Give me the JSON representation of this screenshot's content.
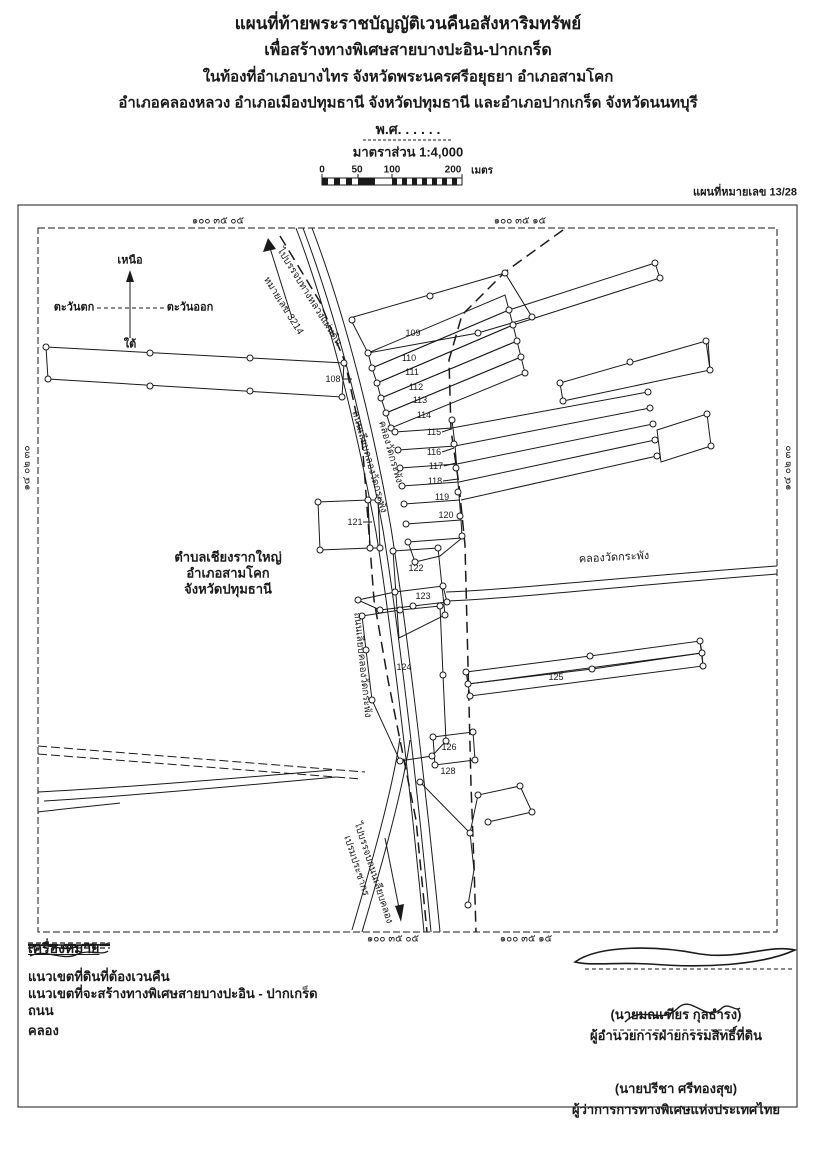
{
  "header": {
    "title_line1": "แผนที่ท้ายพระราชบัญญัติเวนคืนอสังหาริมทรัพย์",
    "title_line2": "เพื่อสร้างทางพิเศษสายบางปะอิน-ปากเกร็ด",
    "title_line3": "ในท้องที่อำเภอบางไทร จังหวัดพระนครศรีอยุธยา อำเภอสามโคก",
    "title_line4": "อำเภอคลองหลวง อำเภอเมืองปทุมธานี จังหวัดปทุมธานี และอำเภอปากเกร็ด จังหวัดนนทบุรี",
    "era_line": "พ.ศ. . . . . .",
    "scale_label": "มาตราส่วน 1:4,000",
    "scale_ticks": {
      "t0": "0",
      "t50": "50",
      "t100": "100",
      "t200": "200",
      "unit": "เมตร"
    },
    "sheet_number": "แผนที่หมายเลข 13/28"
  },
  "compass": {
    "north": "เหนือ",
    "south": "ใต้",
    "east": "ตะวันออก",
    "west": "ตะวันตก"
  },
  "coordinates": {
    "top_left": "๑๐๐ ๓๕ ๐๕",
    "top_right": "๑๐๐ ๓๕ ๑๕",
    "bottom_left": "๑๐๐ ๓๕ ๐๕",
    "bottom_right": "๑๐๐ ๓๕ ๑๕",
    "left_edge": "๑๔ ๐๒ ๓๐",
    "right_edge": "๑๔ ๐๒ ๓๐"
  },
  "map": {
    "area_label": {
      "line1": "ตำบลเชียงรากใหญ่",
      "line2": "อำเภอสามโคก",
      "line3": "จังหวัดปทุมธานี"
    },
    "road_to_north": {
      "line1": "ไปบรรจบทางหลวงแผ่นดิน",
      "line2": "หมายเลข 3214"
    },
    "road_to_south": {
      "line1": "ไปบรรจบถนนเลียบคลอง",
      "line2": "เปรมประชากร"
    },
    "canal_along_road": "คลองวัดกระพัง",
    "road_along_canal": "ถนนเลียบคลองวัดกระพัง",
    "canal_horizontal": "คลองวัดกระพัง",
    "parcels": [
      "108",
      "109",
      "110",
      "111",
      "112",
      "113",
      "114",
      "115",
      "116",
      "117",
      "118",
      "119",
      "120",
      "121",
      "122",
      "123",
      "124",
      "125",
      "126",
      "128"
    ]
  },
  "legend": {
    "heading": "เครื่องหมาย",
    "items": [
      {
        "symbol": "solid-line",
        "label": "แนวเขตที่ดินที่ต้องเวนคืน"
      },
      {
        "symbol": "long-dash-line",
        "label": "แนวเขตที่จะสร้างทางพิเศษสายบางปะอิน - ปากเกร็ด"
      },
      {
        "symbol": "double-dash-line",
        "label": "ถนน"
      },
      {
        "symbol": "wavy-line",
        "label": "คลอง"
      }
    ]
  },
  "signatures": [
    {
      "name": "(นายมณเฑียร กุลธำรง)",
      "title": "ผู้อำนวยการฝ่ายกรรมสิทธิ์ที่ดิน"
    },
    {
      "name": "(นายปรีชา ศรีทองสุข)",
      "title": "ผู้ว่าการการทางพิเศษแห่งประเทศไทย"
    }
  ],
  "colors": {
    "ink": "#1a1a1a",
    "paper": "#ffffff"
  }
}
